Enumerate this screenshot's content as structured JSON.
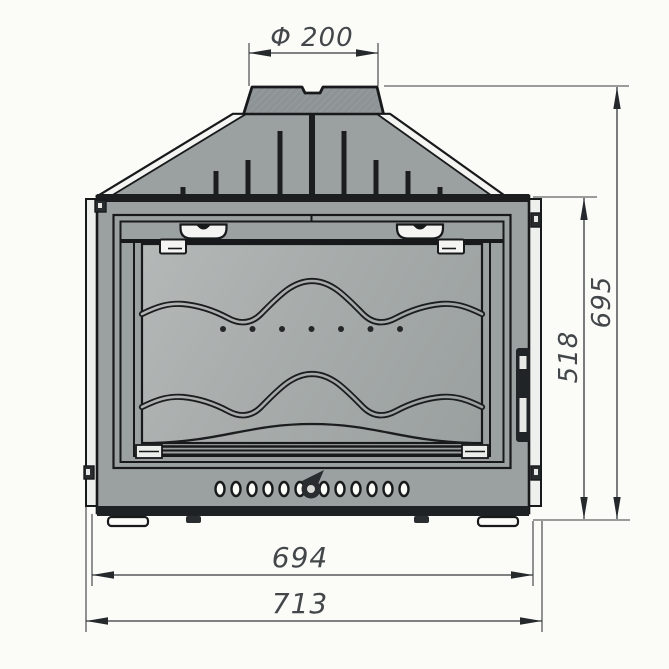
{
  "drawing": {
    "dimensions": {
      "flue_diameter": "Φ 200",
      "height_overall": "695",
      "height_body": "518",
      "width_inner": "694",
      "width_overall": "713"
    },
    "colors": {
      "background": "#fbfbf8",
      "body_gray": "#9ba1a1",
      "collar_gray": "#8e9396",
      "glass_light": "#b4b8b7",
      "glass_dark": "#9aa09f",
      "outline": "#17191b",
      "white_detail": "#f4f5f2",
      "dimension_line": "#33363a",
      "dimension_text": "#43474a"
    }
  }
}
